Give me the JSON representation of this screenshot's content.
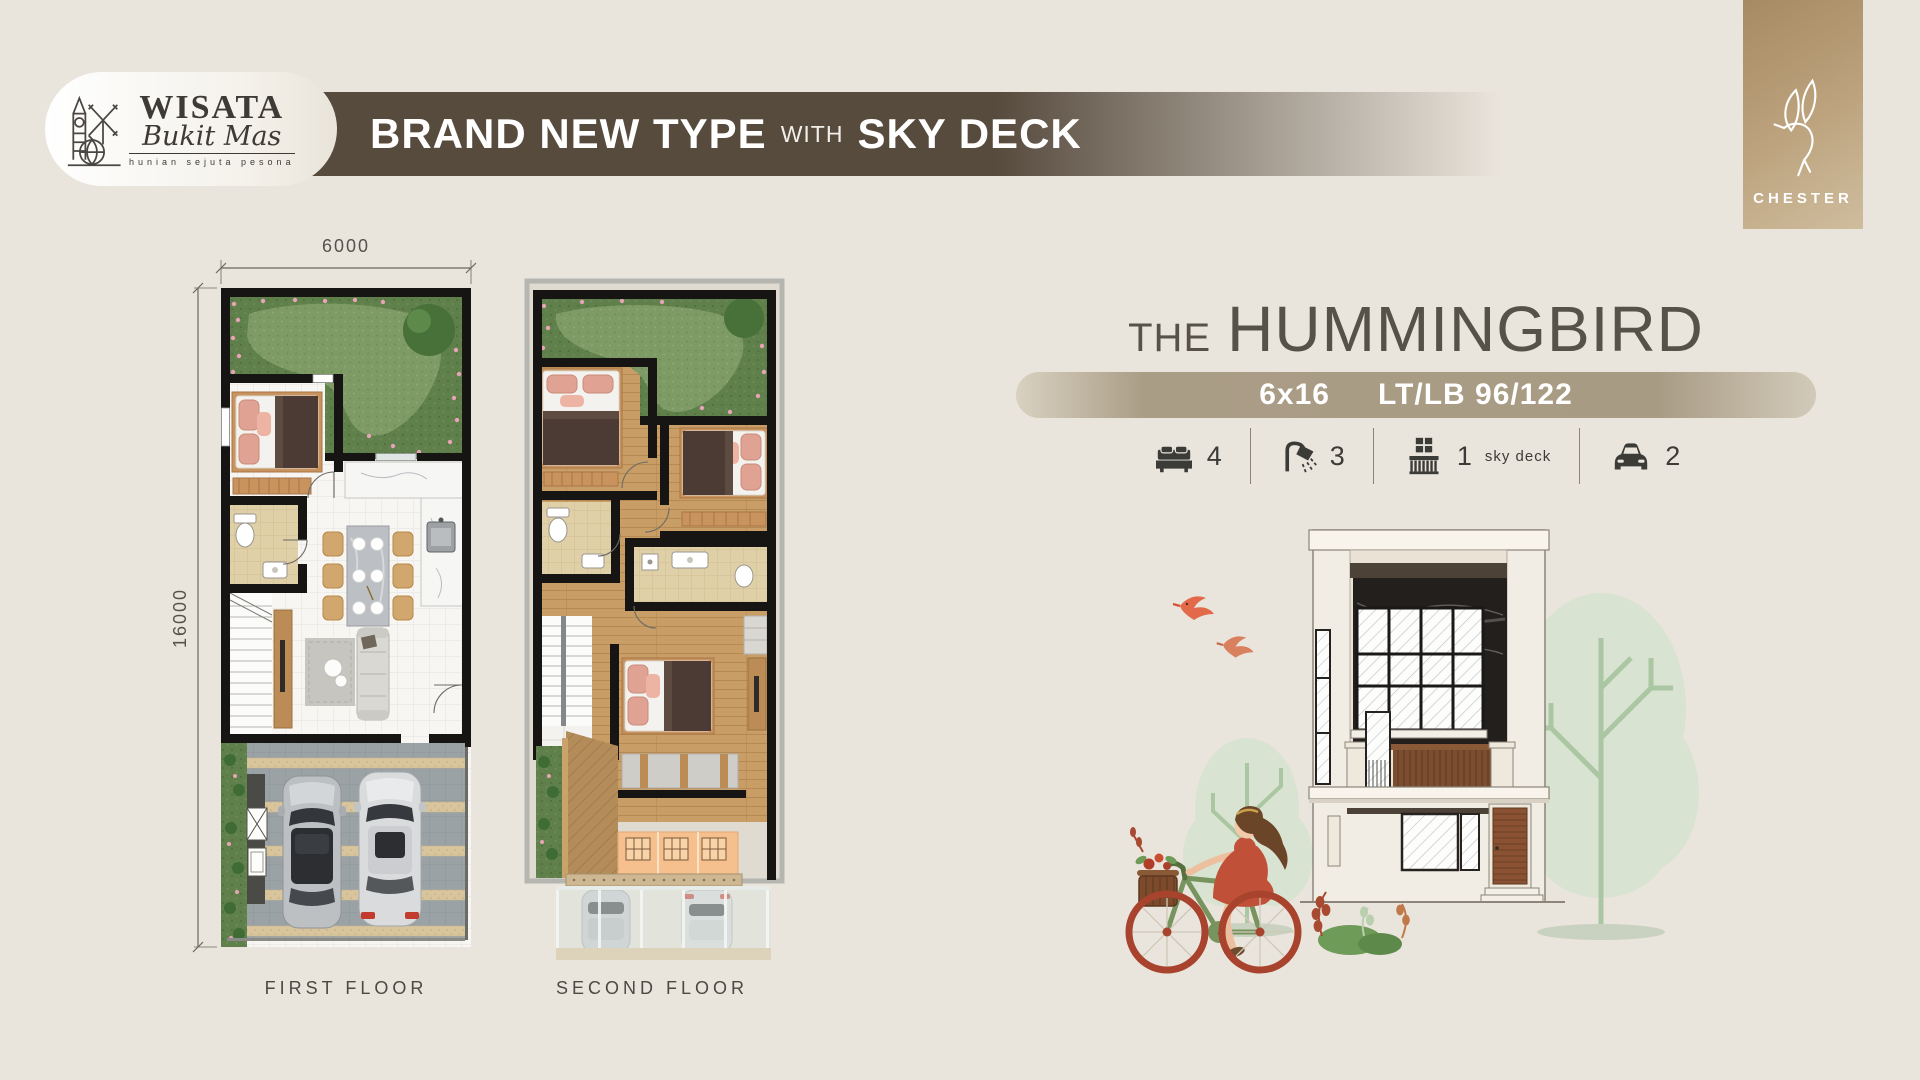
{
  "colors": {
    "background": "#eae5dc",
    "header_bar": "#574b3e",
    "badge_gold_start": "#a68a62",
    "badge_gold_end": "#cfbd9e",
    "title_text": "#56524a",
    "spec_bar": "#a89b84",
    "icon_dark": "#3b3b38",
    "plan_wall": "#171513",
    "garden_green": "#5f7f4b",
    "wood_floor": "#c89d66",
    "accent_red": "#b5402f",
    "bike_green": "#77935e"
  },
  "logo": {
    "name": "WISATA",
    "script": "Bukit Mas",
    "tagline": "hunian sejuta pesona"
  },
  "header": {
    "title_bold": "BRAND NEW TYPE",
    "connector": "WITH",
    "title_accent": "SKY DECK"
  },
  "brand": {
    "name": "CHESTER"
  },
  "product": {
    "article": "THE",
    "name": "HUMMINGBIRD",
    "size": "6x16",
    "area_label": "LT/LB 96/122"
  },
  "features": [
    {
      "icon": "bed-icon",
      "value": "4",
      "label": ""
    },
    {
      "icon": "shower-icon",
      "value": "3",
      "label": ""
    },
    {
      "icon": "sky-deck-icon",
      "value": "1",
      "label": "sky deck"
    },
    {
      "icon": "car-icon",
      "value": "2",
      "label": ""
    }
  ],
  "plans": {
    "first": {
      "label": "FIRST FLOOR",
      "width_dim": "6000",
      "height_dim": "16000"
    },
    "second": {
      "label": "SECOND FLOOR"
    }
  }
}
